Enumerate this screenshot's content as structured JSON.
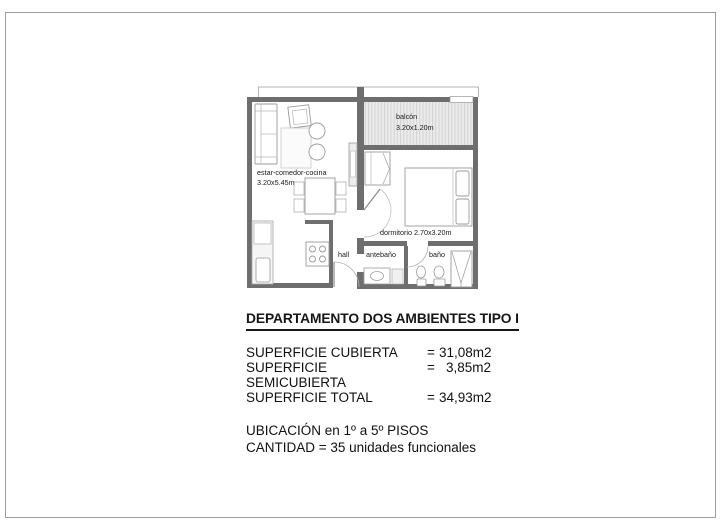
{
  "sheet": {
    "background": "#ffffff",
    "border_color": "#9e9e9e"
  },
  "floorplan": {
    "colors": {
      "wall": "#6e6e6e",
      "furniture_line": "#9a9a9a",
      "balcony_fill": "#ebebeb",
      "balcony_hatch": "#cdcdcd",
      "projection_line": "#b5b5b5"
    },
    "rooms": {
      "living": {
        "label": "estar-comedor-cocina",
        "size": "3.20x5.45m"
      },
      "balcony": {
        "label": "balcón",
        "size": "3.20x1.20m"
      },
      "bedroom": {
        "label": "dormitorio 2.70x3.20m"
      },
      "hall": {
        "label": "hall"
      },
      "antebath": {
        "label": "antebaño"
      },
      "bathroom": {
        "label": "baño"
      }
    }
  },
  "info": {
    "title": "DEPARTAMENTO DOS AMBIENTES TIPO I",
    "surfaces": [
      {
        "label": "SUPERFICIE CUBIERTA",
        "eq": "=",
        "value": "31,08m2"
      },
      {
        "label": "SUPERFICIE SEMICUBIERTA",
        "eq": "=",
        "value": "3,85m2"
      },
      {
        "label": "SUPERFICIE TOTAL",
        "eq": "=",
        "value": "34,93m2"
      }
    ],
    "location": "UBICACIÓN en 1º a 5º PISOS",
    "quantity": "CANTIDAD = 35 unidades funcionales"
  }
}
